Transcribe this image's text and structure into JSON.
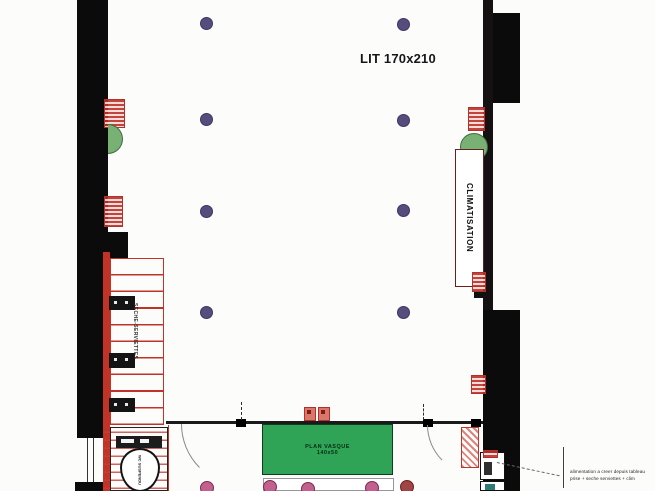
{
  "plan": {
    "bed_label": "LIT 170x210",
    "climatisation_label": "CLIMATISATION",
    "towel_rail_label": "SECHE-SERVIETTES",
    "wc_label": "WC SUSPENDU",
    "vanity_label": {
      "line1": "PLAN VASQUE",
      "line2": "140x50"
    },
    "annotation": {
      "line1": "alimentation a creer depuis tableau",
      "line2": "prise + seche serviettes + clim"
    },
    "legend": {
      "ceiling_spot_count": 8,
      "ceiling_spot_color": "#574d7d",
      "bathroom_spot_count": 5,
      "bathroom_spot_color": "#c2608e",
      "wall_color": "#0b0b0b",
      "equipment_red": "#c23327",
      "ac_unit_green": "#79b074",
      "vanity_green": "#2fa356"
    }
  }
}
